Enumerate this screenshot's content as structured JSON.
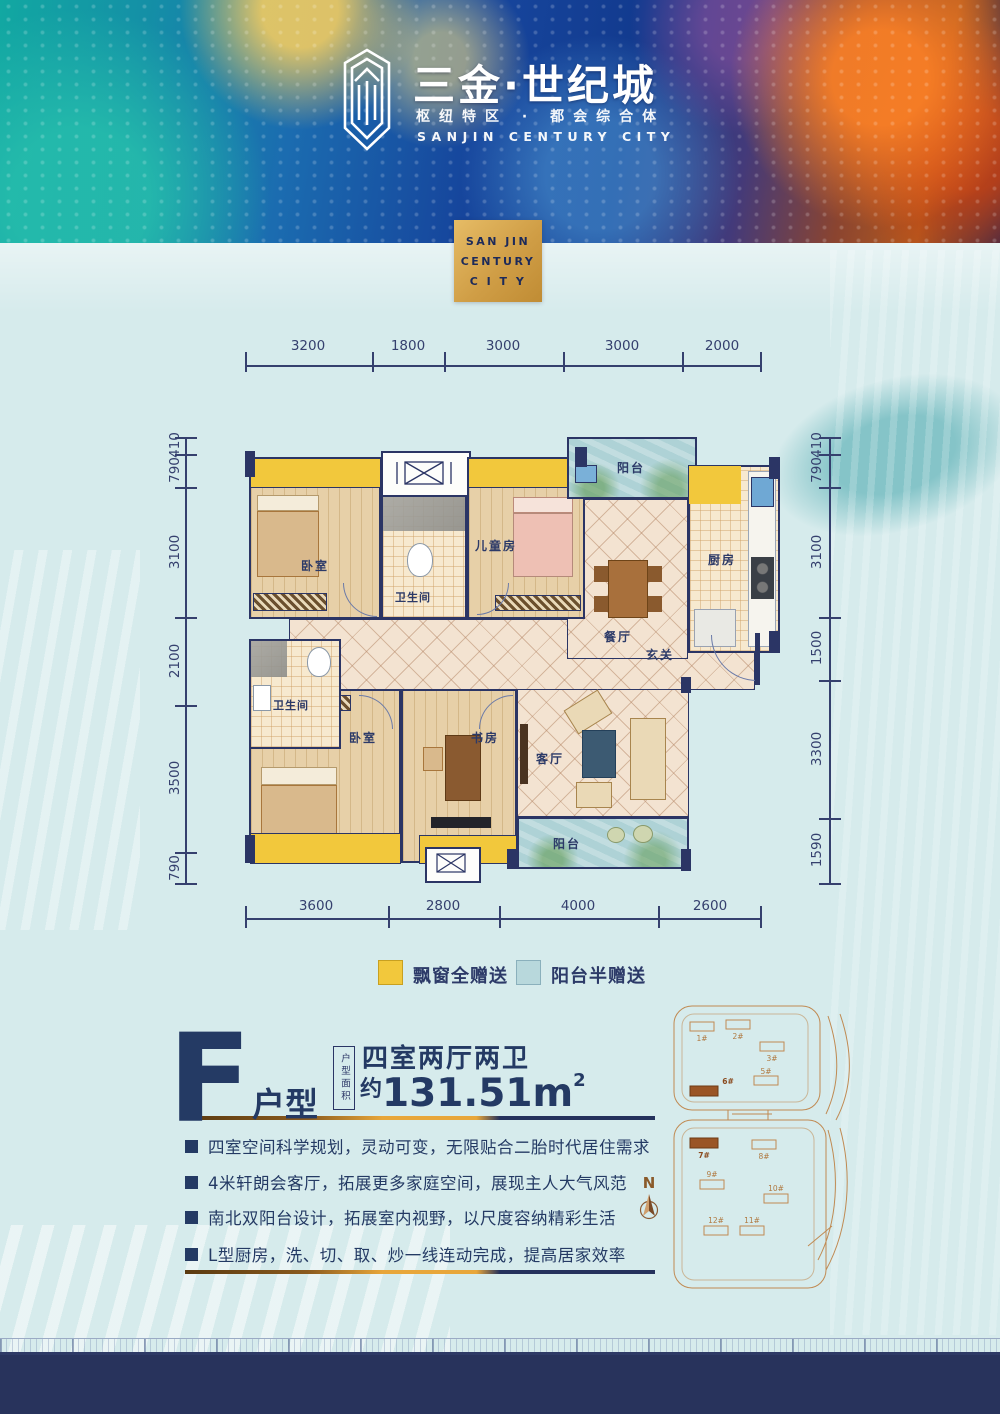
{
  "header": {
    "title": "三金·世纪城",
    "tagline": "枢纽特区 · 都会综合体",
    "english": "SANJIN CENTURY CITY"
  },
  "badge": {
    "line1": "SAN JIN",
    "line2": "CENTURY",
    "line3": "C I T Y"
  },
  "floor_plan": {
    "rooms": {
      "bedroom1": "卧室",
      "bath1": "卫生间",
      "children": "儿童房",
      "balcony_top": "阳台",
      "kitchen": "厨房",
      "dining": "餐厅",
      "foyer": "玄关",
      "bath2": "卫生间",
      "bedroom2": "卧室",
      "study": "书房",
      "living": "客厅",
      "balcony_bottom": "阳台"
    },
    "dims_top": [
      "3200",
      "1800",
      "3000",
      "3000",
      "2000"
    ],
    "dims_bottom": [
      "3600",
      "2800",
      "4000",
      "2600"
    ],
    "dims_left": [
      "410",
      "790",
      "3100",
      "2100",
      "3500",
      "790"
    ],
    "dims_right": [
      "410",
      "790",
      "3100",
      "1500",
      "3300",
      "1590"
    ]
  },
  "legend": {
    "bay_label": "飘窗全赠送",
    "balcony_label": "阳台半赠送"
  },
  "unit": {
    "letter": "F",
    "suffix": "户型",
    "area_box": "户型面积",
    "rooms_text": "四室两厅两卫",
    "area_prefix": "约",
    "area_value": "131.51m",
    "area_sup": "2"
  },
  "features": [
    "四室空间科学规划，灵动可变，无限贴合二胎时代居住需求",
    "4米轩朗会客厅，拓展更多家庭空间，展现主人大气风范",
    "南北双阳台设计，拓展室内视野，以尺度容纳精彩生活",
    "L型厨房，洗、切、取、炒一线连动完成，提高居家效率"
  ],
  "compass": {
    "label": "N"
  },
  "site_plan": {
    "buildings": [
      "1#",
      "2#",
      "3#",
      "5#",
      "6#",
      "7#",
      "8#",
      "9#",
      "10#",
      "11#",
      "12#"
    ]
  },
  "colors": {
    "navy": "#2b3565",
    "bay_yellow": "#f2c83c",
    "balcony_blue": "#aed2d6",
    "gold": "#d0a050",
    "site_line": "#c08a52"
  }
}
